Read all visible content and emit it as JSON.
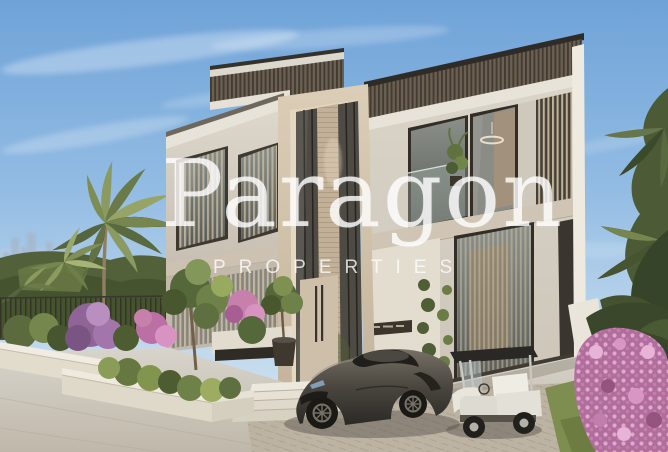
{
  "window": {
    "width": 668,
    "height": 452
  },
  "watermark": {
    "brand": "Paragon",
    "subtitle": "PROPERTIES",
    "color": "#FFFFFF"
  },
  "scene": {
    "description": "3D architectural rendering of a modern two-storey luxury villa with a tall central entrance portal, bronze vertical louvres and floor-to-ceiling glazing; landscaped planters with purple and pink shrubs, palm trees left and right, faint city skyline on the left horizon; a grey open-top supercar and a white golf buggy parked on the paved driveway; pink bougainvillea in the lower right corner",
    "elements": [
      "sky",
      "clouds",
      "city-skyline",
      "palm-trees",
      "garden-hedge",
      "metal-fence",
      "villa-facade",
      "roof-louvre-band",
      "entrance-portal",
      "entrance-door",
      "name-plaque",
      "entrance-steps",
      "potted-tree",
      "planter-walls",
      "flowering-shrubs",
      "garden-tree",
      "driveway",
      "herringbone-paving",
      "lawn",
      "supercar",
      "golf-cart",
      "bougainvillea",
      "right-foliage",
      "balcony",
      "pendant-light"
    ]
  },
  "palette": {
    "sky_top": "#6FA3D8",
    "sky_horizon": "#D7E6F3",
    "facade_light": "#DCD6CB",
    "facade_warm": "#D3C4AC",
    "frame_dark": "#332E28",
    "louvre_band": "#6B6052",
    "vegetation_green": "#5C6B3D",
    "flower_purple": "#9C6FA0",
    "flower_pink": "#D996C4",
    "pavement": "#C9C2B4",
    "car_body": "#4F4B44",
    "cart_body": "#E3E0D8",
    "watermark": "#FFFFFF"
  }
}
